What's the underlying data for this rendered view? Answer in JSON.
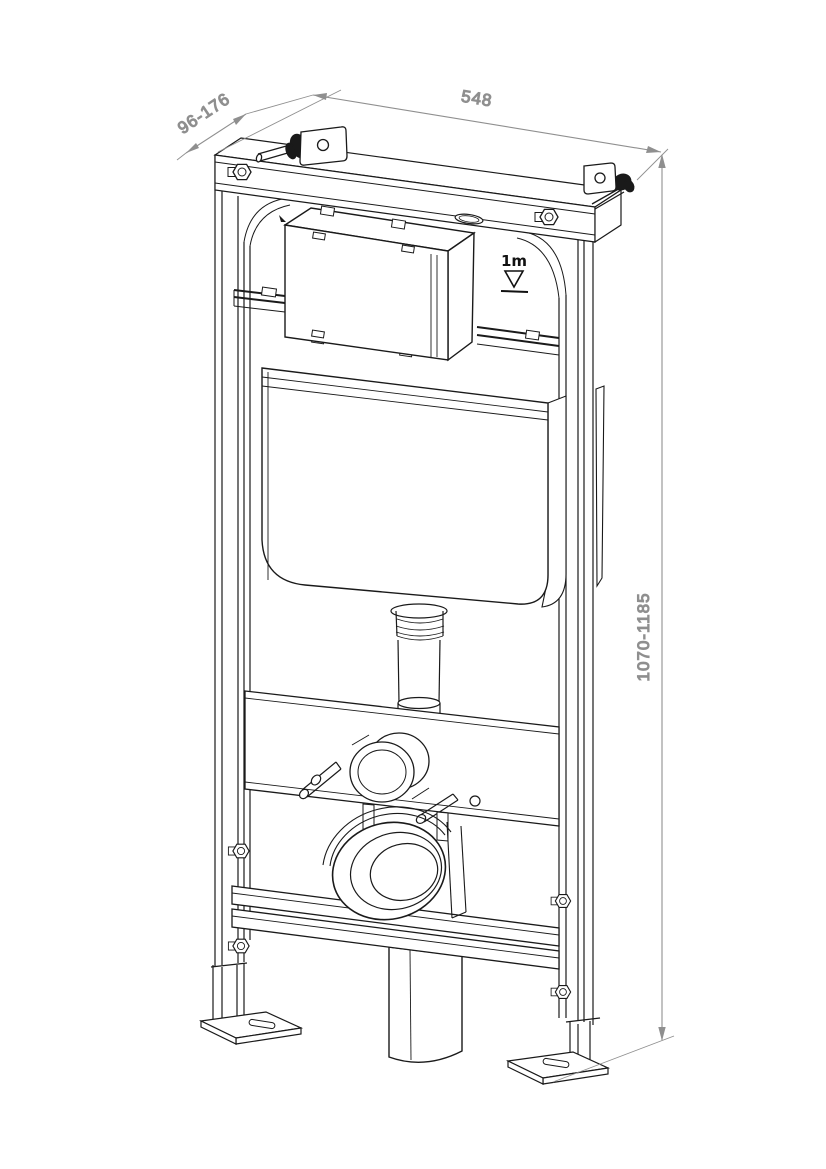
{
  "drawing": {
    "type": "technical_line_drawing",
    "subject": "wall-hung-wc-concealed-cistern-installation-frame",
    "view": "isometric",
    "dimensions": {
      "width": {
        "label": "548"
      },
      "depth": {
        "label": "96-176"
      },
      "height": {
        "label": "1070-1185"
      }
    },
    "meter_mark": {
      "label": "1m"
    },
    "colors": {
      "line": "#1a1a1a",
      "dimension": "#8f8f8f",
      "background": "#ffffff"
    }
  }
}
